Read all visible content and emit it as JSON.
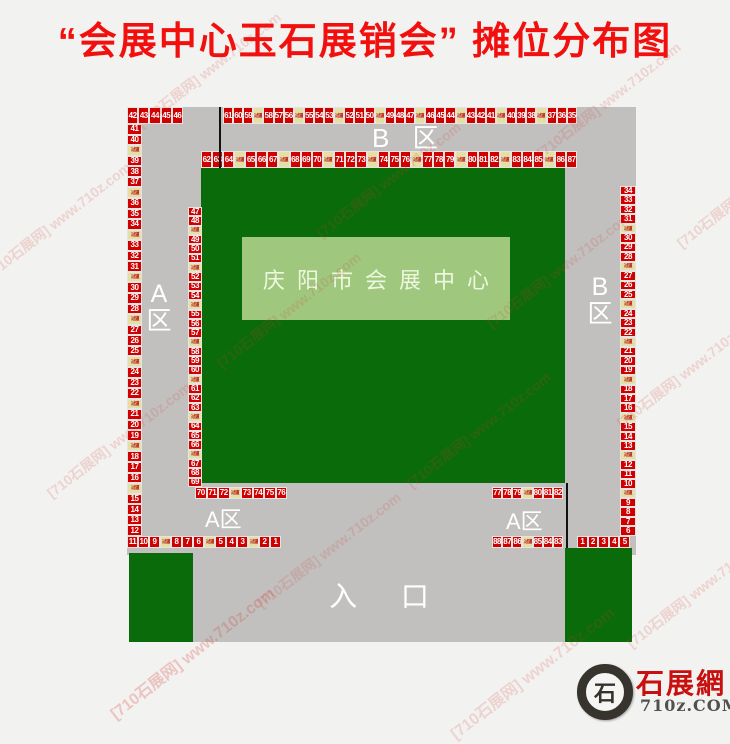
{
  "title": "“会展中心玉石展销会” 摊位分布图",
  "hall_label": "庆阳市会展中心",
  "entrance_label": "入 口",
  "aisle_label": "过道",
  "zone_labels": {
    "top_b": "B 区",
    "left_a_top": "A",
    "left_a_bottom": "区",
    "right_b_top": "B",
    "right_b_bottom": "区",
    "bottom_left_a": "A区",
    "bottom_right_a": "A区"
  },
  "strips": {
    "corner_row": [
      "42",
      "43",
      "44",
      "45",
      "46"
    ],
    "top_outer_row": [
      "61",
      "60",
      "59",
      "过道",
      "58",
      "57",
      "56",
      "过道",
      "55",
      "54",
      "53",
      "过道",
      "52",
      "51",
      "50",
      "过道",
      "49",
      "48",
      "47",
      "过道",
      "46",
      "45",
      "44",
      "过道",
      "43",
      "42",
      "41",
      "过道",
      "40",
      "39",
      "38",
      "过道",
      "37",
      "36",
      "35"
    ],
    "top_inner_row": [
      "62",
      "63",
      "64",
      "过道",
      "65",
      "66",
      "67",
      "过道",
      "68",
      "69",
      "70",
      "过道",
      "71",
      "72",
      "73",
      "过道",
      "74",
      "75",
      "76",
      "过道",
      "77",
      "78",
      "79",
      "过道",
      "80",
      "81",
      "82",
      "过道",
      "83",
      "84",
      "85",
      "过道",
      "86",
      "87"
    ],
    "left_outer_col": [
      "41",
      "40",
      "过道",
      "39",
      "38",
      "37",
      "过道",
      "36",
      "35",
      "34",
      "过道",
      "33",
      "32",
      "31",
      "过道",
      "30",
      "29",
      "28",
      "过道",
      "27",
      "26",
      "25",
      "过道",
      "24",
      "23",
      "22",
      "过道",
      "21",
      "20",
      "19",
      "过道",
      "18",
      "17",
      "16",
      "过道",
      "15",
      "14",
      "13",
      "12"
    ],
    "left_inner_col": [
      "47",
      "48",
      "过道",
      "49",
      "50",
      "51",
      "过道",
      "52",
      "53",
      "54",
      "过道",
      "55",
      "56",
      "57",
      "过道",
      "58",
      "59",
      "60",
      "过道",
      "61",
      "62",
      "63",
      "过道",
      "64",
      "65",
      "66",
      "过道",
      "67",
      "68",
      "69"
    ],
    "right_outer_col": [
      "34",
      "33",
      "32",
      "31",
      "过道",
      "30",
      "29",
      "28",
      "过道",
      "27",
      "26",
      "25",
      "过道",
      "24",
      "23",
      "22",
      "过道",
      "21",
      "20",
      "19",
      "过道",
      "18",
      "17",
      "16",
      "过道",
      "15",
      "14",
      "13",
      "过道",
      "12",
      "11",
      "10",
      "过道",
      "9",
      "8",
      "7",
      "6"
    ],
    "bottom_outer_left_row": [
      "11",
      "10",
      "9",
      "过道",
      "8",
      "7",
      "6",
      "过道",
      "5",
      "4",
      "3",
      "过道",
      "2",
      "1"
    ],
    "bottom_outer_right_row": [
      "88",
      "87",
      "86",
      "过道",
      "85",
      "84",
      "83"
    ],
    "bottom_inner_left_row": [
      "70",
      "71",
      "72",
      "过道",
      "73",
      "74",
      "75",
      "76"
    ],
    "bottom_inner_right_row": [
      "77",
      "78",
      "79",
      "过道",
      "80",
      "81",
      "82"
    ],
    "bottom_right_entry_row": [
      "1",
      "2",
      "3",
      "4",
      "5"
    ]
  },
  "watermark": {
    "text": "[710石展网] www.710z.com",
    "count": 14
  },
  "logo": {
    "glyph": "石",
    "name": "石展網",
    "domain": "710z.COM"
  },
  "colors": {
    "booth_red": "#d10000",
    "aisle_tan": "#e5dfa5",
    "hall_green": "#0a6b0a",
    "hall_box_green": "#9fc87e",
    "map_gray": "#c1c0be",
    "title_red": "#f2100e",
    "background": "#f2f2f0"
  }
}
